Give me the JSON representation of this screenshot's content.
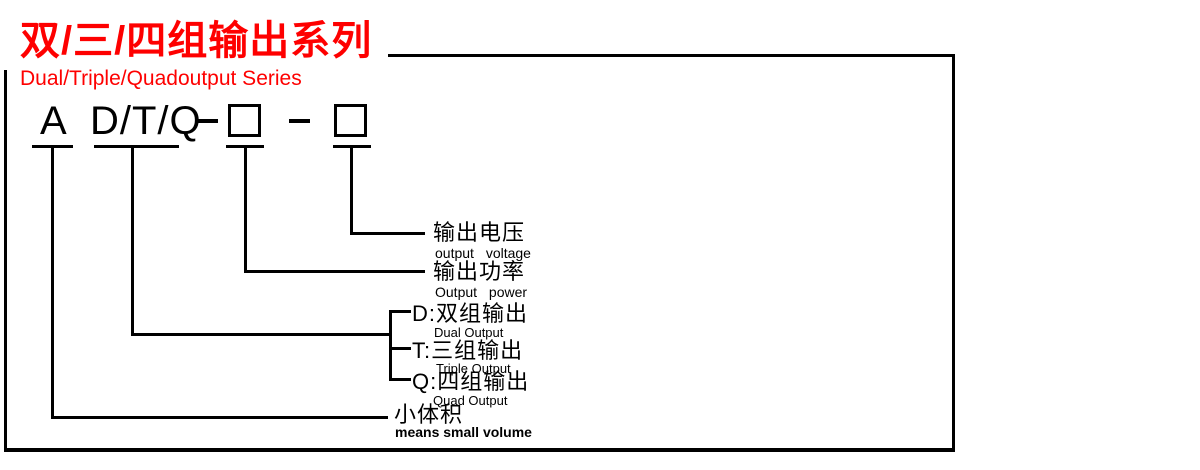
{
  "series_header": {
    "title_zh": "双/三/四组输出系列",
    "title_en": "Dual/Triple/Quadoutput Series"
  },
  "model_code": {
    "prefix": "A",
    "type_options": "D/T/Q",
    "separator1": "-",
    "separator2": "-",
    "power_box": "",
    "voltage_box": ""
  },
  "annotations": {
    "output_voltage": {
      "zh": "输出电压",
      "en": "output  voltage"
    },
    "output_power": {
      "zh": "输出功率",
      "en": "Output  power"
    },
    "dual_output": {
      "zh": "D:双组输出",
      "en": "Dual Output"
    },
    "triple_output": {
      "zh": "T:三组输出",
      "en": "Triple Output"
    },
    "quad_output": {
      "zh": "Q:四组输出",
      "en": "Quad Output"
    },
    "small_volume": {
      "zh": "小体积",
      "en": "means small volume"
    }
  },
  "colors": {
    "accent_red": "#fe0000",
    "line_black": "#000000"
  }
}
